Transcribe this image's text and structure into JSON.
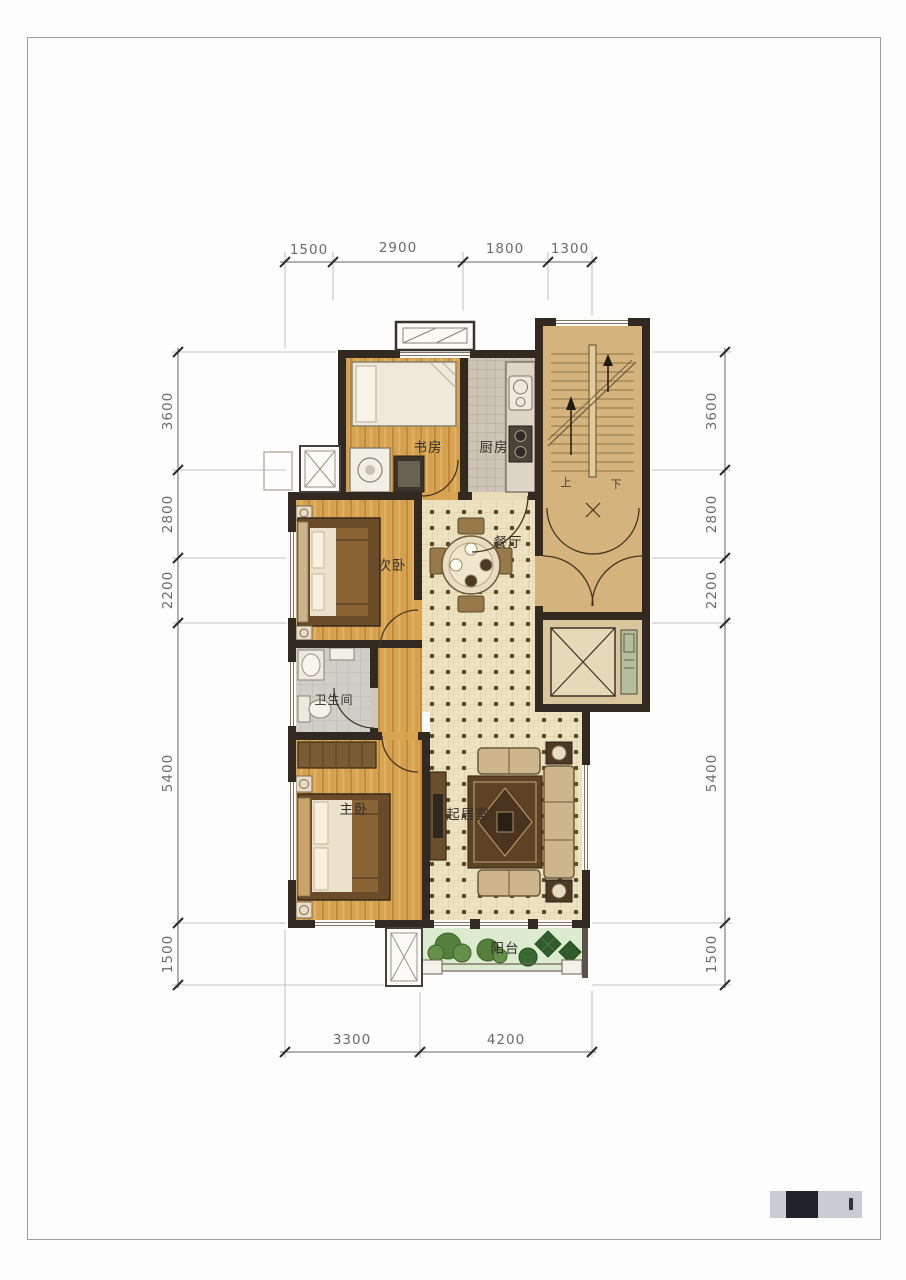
{
  "rooms": {
    "study": "书房",
    "kitchen": "厨房",
    "second_bedroom": "次卧",
    "dining": "餐厅",
    "bathroom": "卫生间",
    "master_bedroom": "主卧",
    "living": "起居室",
    "balcony": "阳台"
  },
  "stairs": {
    "up": "上",
    "down": "下"
  },
  "dimensions": {
    "top": [
      "1500",
      "2900",
      "1800",
      "1300"
    ],
    "left": [
      "3600",
      "2800",
      "2200",
      "5400",
      "1500"
    ],
    "right": [
      "3600",
      "2800",
      "2200",
      "5400",
      "1500"
    ],
    "bottom": [
      "3300",
      "4200"
    ]
  },
  "colors": {
    "wall": "#322a21",
    "wood_floor": "#d8a452",
    "tile_floor": "#ece1bf",
    "kitchen_floor": "#cdc4b6",
    "bath_floor": "#cfcfc8",
    "stair_floor": "#d4b47c",
    "balcony_floor": "#dcead0",
    "dimension_text": "#6b6b6b"
  }
}
